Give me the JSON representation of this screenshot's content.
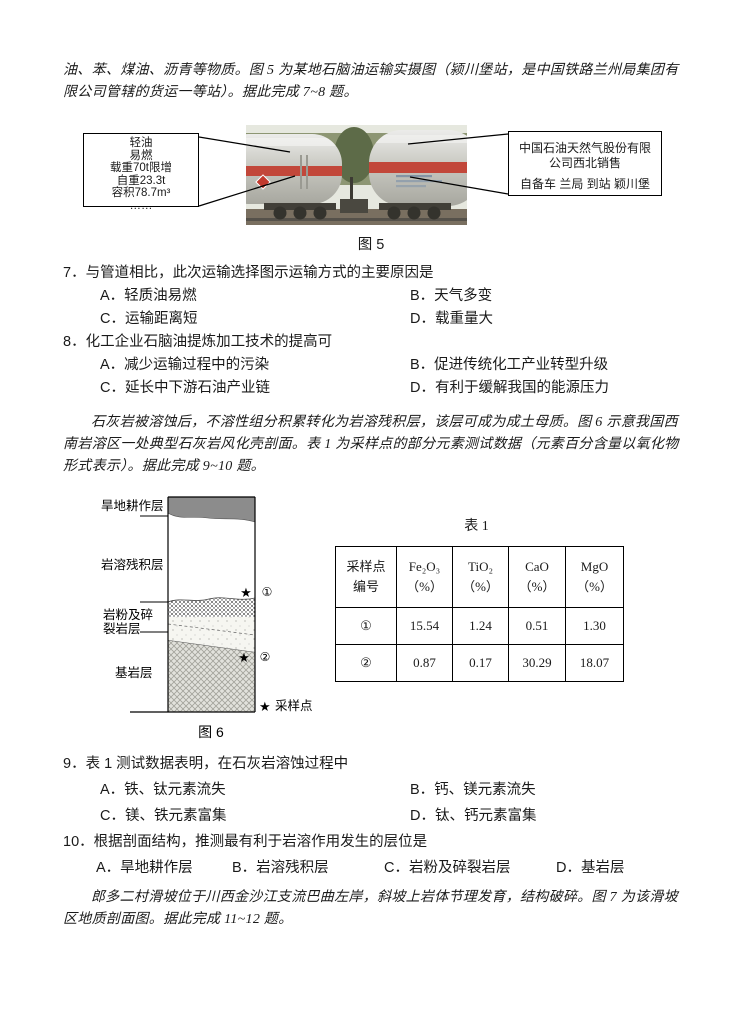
{
  "intro_oil": "油、苯、煤油、沥青等物质。图 5 为某地石脑油运输实摄图（颍川堡站，是中国铁路兰州局集团有限公司管辖的货运一等站）。据此完成 7~8 题。",
  "fig5": {
    "caption": "图 5",
    "left_box": {
      "lines": [
        "轻油",
        "易燃",
        "载重70t限增",
        "自重23.3t",
        "容积78.7m³",
        "……"
      ]
    },
    "right_box": {
      "lines": [
        "中国石油天然气股份有限",
        "公司西北销售",
        "自备车 兰局 到站 颖川堡"
      ]
    },
    "photo": {
      "description": "铁路石脑油罐车照片",
      "tank_color": "#c9c9c2",
      "stripe_color": "#c2473a",
      "foliage_color": "#8d9673",
      "ground_color": "#796f60"
    }
  },
  "questions": [
    {
      "stem": "7．与管道相比，此次运输选择图示运输方式的主要原因是",
      "options": [
        "A．轻质油易燃",
        "B．天气多变",
        "C．运输距离短",
        "D．载重量大"
      ]
    },
    {
      "stem": "8．化工企业石脑油提炼加工技术的提高可",
      "options": [
        "A．减少运输过程中的污染",
        "B．促进传统化工产业转型升级",
        "C．延长中下游石油产业链",
        "D．有利于缓解我国的能源压力"
      ]
    },
    {
      "stem": "9．表 1 测试数据表明，在石灰岩溶蚀过程中",
      "options": [
        "A．铁、钛元素流失",
        "B．钙、镁元素流失",
        "C．镁、铁元素富集",
        "D．钛、钙元素富集"
      ]
    },
    {
      "stem": "10．根据剖面结构，推测最有利于岩溶作用发生的层位是",
      "options": [
        "A．旱地耕作层",
        "B．岩溶残积层",
        "C．岩粉及碎裂岩层",
        "D．基岩层"
      ]
    }
  ],
  "intro_limestone": "石灰岩被溶蚀后，不溶性组分积累转化为岩溶残积层，该层可成为成土母质。图 6 示意我国西南岩溶区一处典型石灰岩风化壳剖面。表 1 为采样点的部分元素测试数据（元素百分含量以氧化物形式表示）。据此完成 9~10 题。",
  "fig6": {
    "caption": "图 6",
    "layer1": "旱地耕作层",
    "layer2": "岩溶残积层",
    "layer3a": "岩粉及碎",
    "layer3b": "裂岩层",
    "layer4": "基岩层",
    "star": "★",
    "mark1": "①",
    "mark2": "②",
    "legend_star": "★",
    "legend_text": "采样点"
  },
  "table1": {
    "caption": "表 1",
    "col0": {
      "line1": "采样点",
      "line2": "编号"
    },
    "headers": [
      {
        "formula": "Fe₂O₃",
        "unit": "（%）"
      },
      {
        "formula": "TiO₂",
        "unit": "（%）"
      },
      {
        "formula": "CaO",
        "unit": "（%）"
      },
      {
        "formula": "MgO",
        "unit": "（%）"
      }
    ],
    "rows": [
      {
        "id": "①",
        "values": [
          "15.54",
          "1.24",
          "0.51",
          "1.30"
        ]
      },
      {
        "id": "②",
        "values": [
          "0.87",
          "0.17",
          "30.29",
          "18.07"
        ]
      }
    ]
  },
  "intro_landslide": "郎多二村滑坡位于川西金沙江支流巴曲左岸，斜坡上岩体节理发育，结构破碎。图 7 为该滑坡区地质剖面图。据此完成 11~12 题。"
}
